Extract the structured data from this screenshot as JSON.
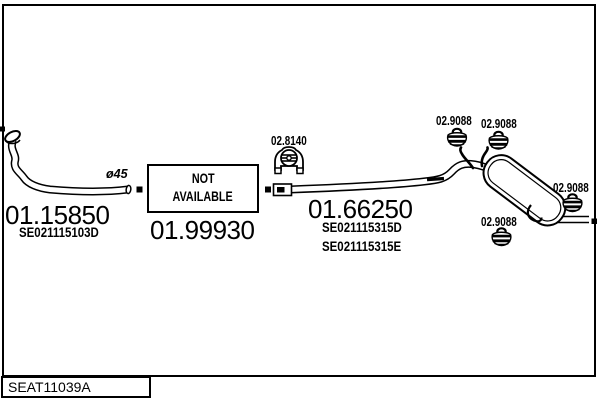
{
  "drawing": {
    "code": "SEAT11039A",
    "parts": [
      {
        "number": "01.15850",
        "ref1": "SE021115103D"
      },
      {
        "number": "01.99930"
      },
      {
        "number": "01.66250",
        "ref1": "SE021115315D",
        "ref2": "SE021115315E"
      }
    ],
    "not_available": {
      "line1": "NOT",
      "line2": "AVAILABLE"
    },
    "mounts": {
      "bracket": "02.8140",
      "hanger1": "02.9088",
      "hanger2": "02.9088",
      "hanger3": "02.9088",
      "hanger4": "02.9088"
    },
    "diameter": "ø45",
    "colors": {
      "ink": "#000000",
      "paper": "#ffffff"
    }
  }
}
